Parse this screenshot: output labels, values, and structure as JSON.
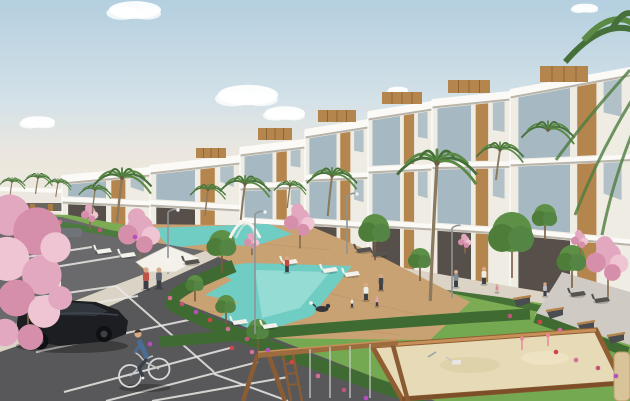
{
  "scene": {
    "type": "architectural-exterior-render",
    "description": "Sunny render of a modern white apartment complex with rooftop wood volumes, communal turquoise pools on a timber deck, lawns, palm and pink blossom trees, a parking lot with a black car and a cyclist, benches along a path, and a children's sandbox with a wooden play frame.",
    "elements": [
      "sky",
      "clouds",
      "apartment-buildings",
      "rooftop-wood-boxes",
      "balconies",
      "swimming-pools",
      "pool-deck",
      "lawn",
      "walkway",
      "bench-path",
      "parking-lot",
      "parking-lines",
      "black-car",
      "distant-cars",
      "cyclist",
      "pedestrians",
      "dog",
      "palm-trees",
      "blossom-trees",
      "green-trees",
      "hedges",
      "flowers",
      "sun-canopy",
      "pergola-arch",
      "loungers",
      "benches",
      "lamp-posts",
      "sandbox",
      "play-frame"
    ]
  },
  "palette": {
    "sky_top": "#b4cfdf",
    "sky_mid": "#d3e1e8",
    "sky_horizon": "#ece7de",
    "cloud": "#ffffff",
    "building_wall": "#efece4",
    "building_slab": "#fbfaf7",
    "building_shade": "#8d8778",
    "glass": "#9db3bd",
    "wood": "#b5854e",
    "wood_dark": "#9c6b3e",
    "grass": "#7cab54",
    "grass_fore": "#74a851",
    "hedge": "#3f6b33",
    "pool": "#6fcdc4",
    "pool_light": "#b2eae1",
    "deck": "#c9a273",
    "path": "#dbd4c6",
    "path_gray": "#cfcac3",
    "asphalt": "#6a696b",
    "asphalt_near": "#58585a",
    "line_white": "#eceae6",
    "blossom": "#e2a8bf",
    "blossom_dark": "#d68fab",
    "blossom_light": "#efc4d3",
    "sand": "#e7dab6",
    "trunk": "#8a6a4a",
    "frond_a": "#5a8a44",
    "frond_b": "#46703a",
    "skin": "#d9a987"
  },
  "modules": [
    {
      "x1": 62,
      "x2": 150,
      "rl": 178,
      "rr": 170,
      "bl": 216,
      "br": 232,
      "f": 2,
      "box": null
    },
    {
      "x1": 150,
      "x2": 240,
      "rl": 168,
      "rr": 158,
      "bl": 232,
      "br": 252,
      "f": 2,
      "box": [
        196,
        148,
        30,
        10
      ]
    },
    {
      "x1": 240,
      "x2": 305,
      "rl": 150,
      "rr": 142,
      "bl": 252,
      "br": 262,
      "f": 3,
      "box": [
        258,
        128,
        34,
        12
      ]
    },
    {
      "x1": 305,
      "x2": 368,
      "rl": 132,
      "rr": 122,
      "bl": 262,
      "br": 273,
      "f": 3,
      "box": [
        318,
        110,
        38,
        12
      ]
    },
    {
      "x1": 368,
      "x2": 432,
      "rl": 114,
      "rr": 104,
      "bl": 273,
      "br": 284,
      "f": 3,
      "box": [
        382,
        92,
        40,
        12
      ]
    },
    {
      "x1": 432,
      "x2": 510,
      "rl": 102,
      "rr": 94,
      "bl": 284,
      "br": 296,
      "f": 3,
      "box": [
        448,
        80,
        42,
        13
      ]
    },
    {
      "x1": 510,
      "x2": 630,
      "rl": 92,
      "rr": 70,
      "bl": 296,
      "br": 324,
      "f": 3,
      "box": [
        540,
        66,
        48,
        16
      ]
    }
  ],
  "clouds": [
    {
      "x": 135,
      "y": 10,
      "r": 26
    },
    {
      "x": 248,
      "y": 95,
      "r": 30
    },
    {
      "x": 285,
      "y": 113,
      "r": 20
    },
    {
      "x": 38,
      "y": 122,
      "r": 17
    },
    {
      "x": 398,
      "y": 90,
      "r": 10
    },
    {
      "x": 585,
      "y": 8,
      "r": 13
    }
  ],
  "palms": [
    {
      "x": 122,
      "y": 178,
      "s": 1.0,
      "tl": 44
    },
    {
      "x": 245,
      "y": 184,
      "s": 0.85,
      "tl": 36
    },
    {
      "x": 332,
      "y": 176,
      "s": 0.85,
      "tl": 40
    },
    {
      "x": 437,
      "y": 163,
      "s": 1.35,
      "tl": 138
    },
    {
      "x": 95,
      "y": 190,
      "s": 0.55,
      "tl": 24
    },
    {
      "x": 12,
      "y": 182,
      "s": 0.45,
      "tl": 16
    },
    {
      "x": 38,
      "y": 178,
      "s": 0.5,
      "tl": 16
    },
    {
      "x": 58,
      "y": 183,
      "s": 0.45,
      "tl": 14
    },
    {
      "x": 208,
      "y": 190,
      "s": 0.6,
      "tl": 26
    },
    {
      "x": 290,
      "y": 186,
      "s": 0.55,
      "tl": 22
    },
    {
      "x": 500,
      "y": 150,
      "s": 0.8,
      "tl": 30
    },
    {
      "x": 548,
      "y": 130,
      "s": 0.9,
      "tl": 0
    }
  ],
  "giant_palm": {
    "x": 648,
    "y": 38,
    "s": 2.8
  },
  "green_trees": [
    {
      "x": 222,
      "y": 243,
      "r": 13
    },
    {
      "x": 375,
      "y": 228,
      "r": 14
    },
    {
      "x": 512,
      "y": 232,
      "r": 20
    },
    {
      "x": 572,
      "y": 258,
      "r": 13
    },
    {
      "x": 195,
      "y": 283,
      "r": 8
    },
    {
      "x": 226,
      "y": 304,
      "r": 9
    },
    {
      "x": 258,
      "y": 329,
      "r": 10
    },
    {
      "x": 160,
      "y": 262,
      "r": 9
    },
    {
      "x": 545,
      "y": 215,
      "r": 11
    },
    {
      "x": 420,
      "y": 258,
      "r": 10
    }
  ],
  "blossom_trees": [
    {
      "x": 140,
      "y": 228,
      "r": 22
    },
    {
      "x": 300,
      "y": 218,
      "r": 16
    },
    {
      "x": 90,
      "y": 212,
      "r": 9
    },
    {
      "x": 252,
      "y": 240,
      "r": 8
    },
    {
      "x": 580,
      "y": 238,
      "r": 9
    },
    {
      "x": 465,
      "y": 240,
      "r": 7
    }
  ],
  "blossom_foreground": [
    {
      "x": 28,
      "y": 252,
      "r": 46,
      "big": 1
    },
    {
      "x": 608,
      "y": 256,
      "r": 22
    }
  ],
  "people": [
    {
      "x": 146,
      "y": 289,
      "h": 19,
      "c": "#c05248"
    },
    {
      "x": 159,
      "y": 288,
      "h": 18,
      "c": "#60666e"
    },
    {
      "x": 47,
      "y": 293,
      "h": 13,
      "c": "#9db7cc"
    },
    {
      "x": 59,
      "y": 292,
      "h": 13,
      "c": "#eae8e2"
    },
    {
      "x": 287,
      "y": 272,
      "h": 14,
      "c": "#c24b40"
    },
    {
      "x": 456,
      "y": 287,
      "h": 15,
      "c": "#878c93"
    },
    {
      "x": 484,
      "y": 284,
      "h": 15,
      "c": "#eeebe5"
    },
    {
      "x": 497,
      "y": 292,
      "h": 9,
      "c": "#d78ca0",
      "sit": 1
    },
    {
      "x": 366,
      "y": 300,
      "h": 15,
      "c": "#efede7"
    },
    {
      "x": 381,
      "y": 290,
      "h": 14,
      "c": "#41464d"
    },
    {
      "x": 377,
      "y": 306,
      "h": 9,
      "c": "#dfa6b6"
    },
    {
      "x": 352,
      "y": 307,
      "h": 8,
      "c": "#eae8e1"
    },
    {
      "x": 545,
      "y": 296,
      "h": 12,
      "c": "#b9bec4"
    }
  ],
  "loungers": [
    {
      "x": 282,
      "y": 259
    },
    {
      "x": 322,
      "y": 267
    },
    {
      "x": 344,
      "y": 271
    },
    {
      "x": 232,
      "y": 319
    },
    {
      "x": 262,
      "y": 323
    },
    {
      "x": 120,
      "y": 252
    },
    {
      "x": 96,
      "y": 248
    },
    {
      "x": 184,
      "y": 259,
      "d": 1
    },
    {
      "x": 356,
      "y": 247,
      "d": 1
    },
    {
      "x": 372,
      "y": 251,
      "d": 1
    },
    {
      "x": 570,
      "y": 291,
      "d": 1
    },
    {
      "x": 594,
      "y": 297,
      "d": 1
    }
  ],
  "benches": [
    {
      "x": 514,
      "y": 300
    },
    {
      "x": 547,
      "y": 312
    },
    {
      "x": 578,
      "y": 325
    },
    {
      "x": 608,
      "y": 337
    }
  ],
  "lamps": [
    {
      "x": 168,
      "y": 212,
      "h": 46
    },
    {
      "x": 255,
      "y": 214,
      "h": 120
    },
    {
      "x": 452,
      "y": 228,
      "h": 70
    },
    {
      "x": 347,
      "y": 196,
      "h": 58
    }
  ],
  "parking_lines": [
    [
      0,
      248,
      58,
      239
    ],
    [
      0,
      261,
      92,
      247
    ],
    [
      6,
      275,
      128,
      255
    ],
    [
      18,
      300,
      116,
      286
    ],
    [
      26,
      314,
      138,
      296
    ],
    [
      116,
      286,
      214,
      372
    ],
    [
      36,
      352,
      198,
      318
    ],
    [
      64,
      392,
      230,
      348
    ],
    [
      106,
      401,
      258,
      362
    ],
    [
      152,
      401,
      288,
      377
    ],
    [
      214,
      374,
      288,
      401
    ]
  ],
  "flowers": [
    [
      170,
      298
    ],
    [
      182,
      304
    ],
    [
      196,
      312
    ],
    [
      210,
      320
    ],
    [
      228,
      329
    ],
    [
      247,
      339
    ],
    [
      268,
      350
    ],
    [
      292,
      362
    ],
    [
      318,
      376
    ],
    [
      344,
      390
    ],
    [
      366,
      398
    ],
    [
      20,
      216
    ],
    [
      60,
      222
    ],
    [
      100,
      230
    ],
    [
      135,
      237
    ],
    [
      556,
      352
    ],
    [
      576,
      360
    ],
    [
      598,
      368
    ],
    [
      616,
      376
    ],
    [
      540,
      322
    ],
    [
      560,
      330
    ],
    [
      510,
      316
    ],
    [
      150,
      344
    ],
    [
      232,
      348
    ],
    [
      252,
      352
    ]
  ]
}
